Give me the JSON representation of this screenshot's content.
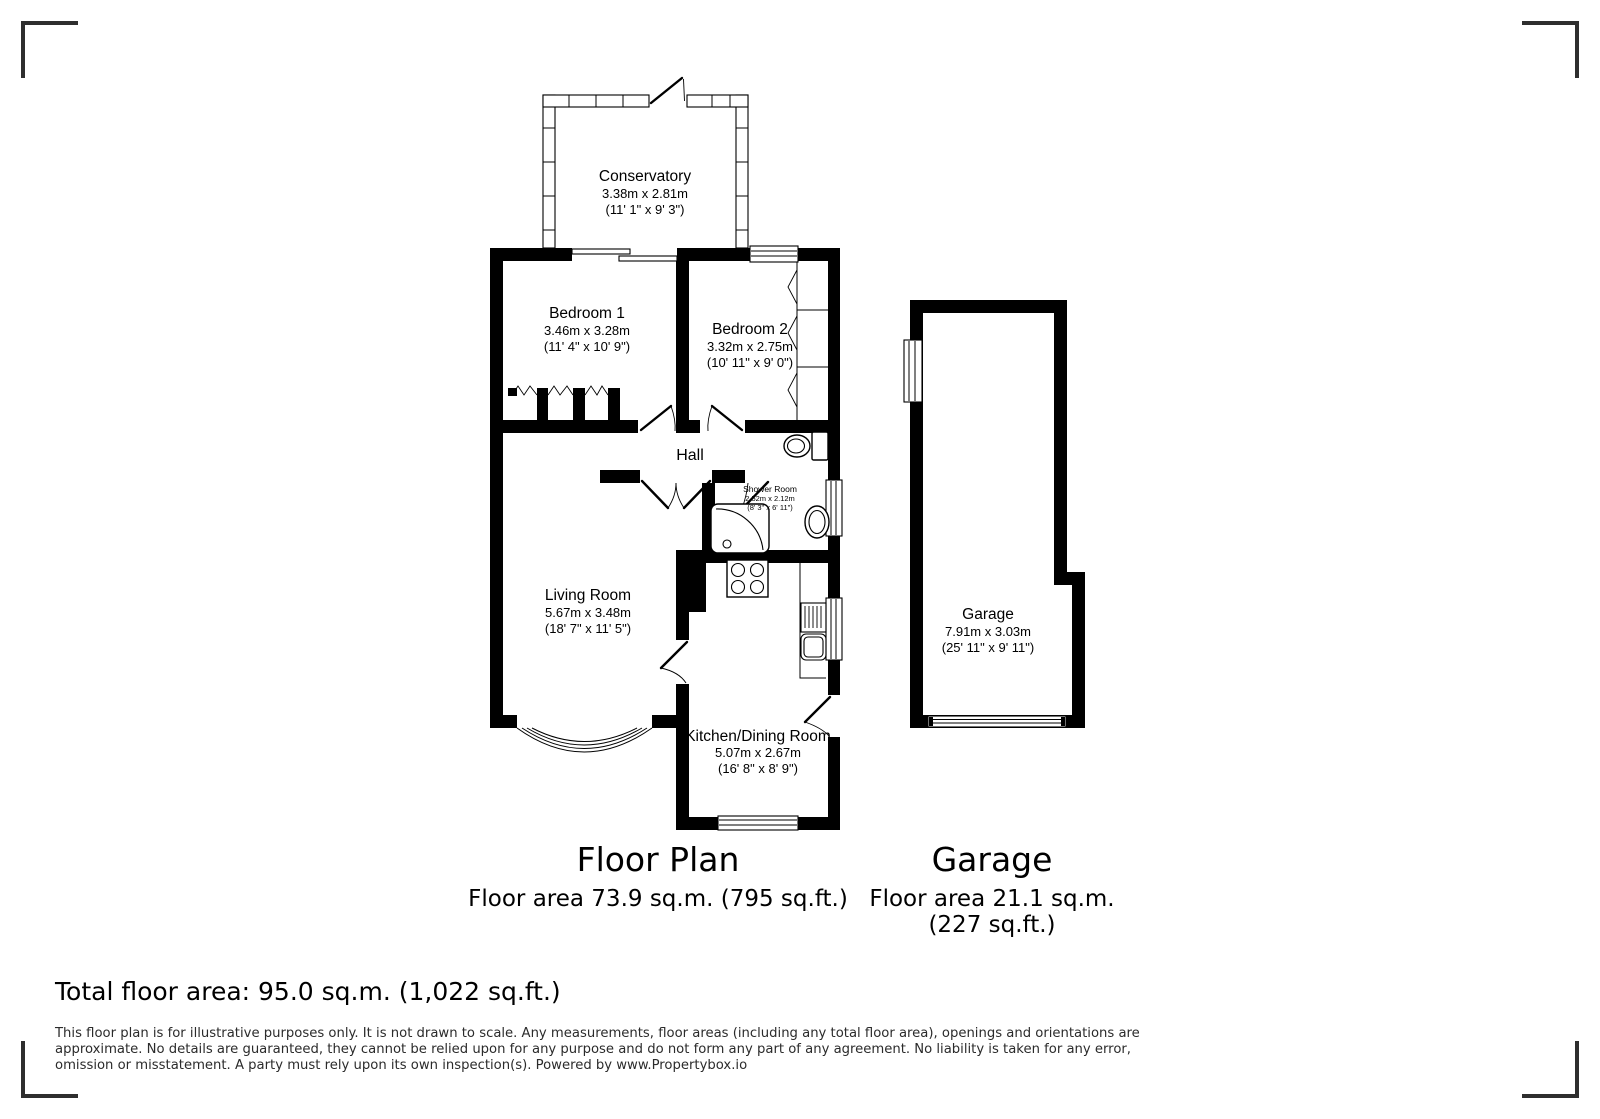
{
  "plan": {
    "rooms": {
      "conservatory": {
        "name": "Conservatory",
        "metric": "3.38m x 2.81m",
        "imperial": "(11' 1\" x 9' 3\")"
      },
      "bedroom1": {
        "name": "Bedroom 1",
        "metric": "3.46m x 3.28m",
        "imperial": "(11' 4\" x 10' 9\")"
      },
      "bedroom2": {
        "name": "Bedroom 2",
        "metric": "3.32m x 2.75m",
        "imperial": "(10' 11\" x 9' 0\")"
      },
      "hall": {
        "name": "Hall"
      },
      "shower": {
        "name": "Shower Room",
        "metric": "2.52m x 2.12m",
        "imperial": "(8' 3\" x 6' 11\")"
      },
      "living": {
        "name": "Living Room",
        "metric": "5.67m x 3.48m",
        "imperial": "(18' 7\" x 11' 5\")"
      },
      "kitchen": {
        "name": "Kitchen/Dining Room",
        "metric": "5.07m x 2.67m",
        "imperial": "(16' 8\" x 8' 9\")"
      },
      "garage": {
        "name": "Garage",
        "metric": "7.91m x 3.03m",
        "imperial": "(25' 11\" x 9' 11\")"
      }
    },
    "captions": {
      "floorplan_title": "Floor Plan",
      "floorplan_area": "Floor area 73.9 sq.m. (795 sq.ft.)",
      "garage_title": "Garage",
      "garage_area_line1": "Floor area 21.1 sq.m.",
      "garage_area_line2": "(227 sq.ft.)"
    }
  },
  "footer": {
    "total_area": "Total floor area: 95.0 sq.m. (1,022 sq.ft.)",
    "disclaimer_line1": "This floor plan is for illustrative purposes only. It is not drawn to scale. Any measurements, floor areas (including any total floor area), openings and orientations are",
    "disclaimer_line2": "approximate. No details are guaranteed, they cannot be relied upon for any purpose and do not form any part of any agreement. No liability is taken for any error,",
    "disclaimer_line3": "omission or misstatement. A party must rely upon its own inspection(s). Powered by www.Propertybox.io"
  }
}
